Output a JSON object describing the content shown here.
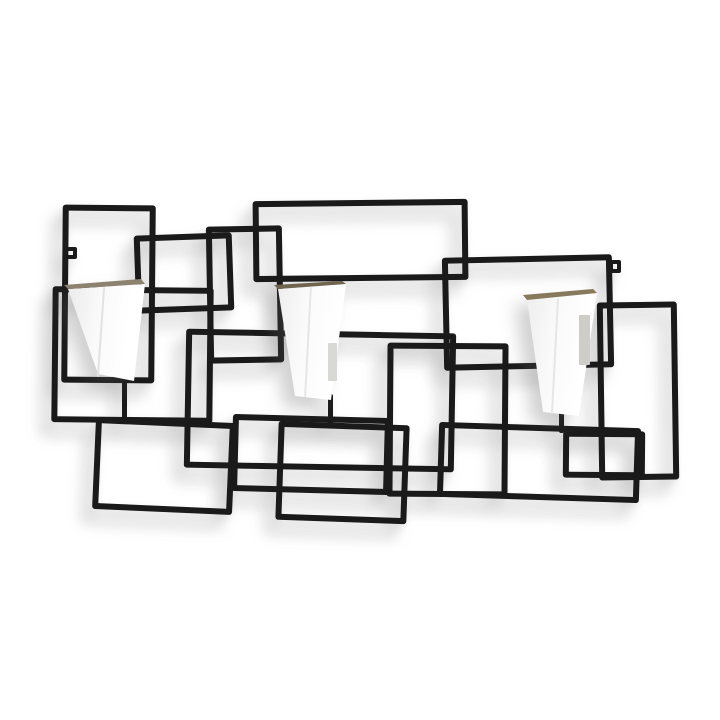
{
  "scene": {
    "canvas": {
      "width": 720,
      "height": 720,
      "background_color": "#ffffff"
    },
    "frame": {
      "wire_color": "#1a1a1a",
      "wire_thickness": 6,
      "rectangles": [
        {
          "name": "frame-rect-top-left-tall",
          "x": 62,
          "y": 205,
          "w": 93,
          "h": 178,
          "rot": 0.5
        },
        {
          "name": "frame-rect-left-small-square",
          "x": 135,
          "y": 234,
          "w": 98,
          "h": 78,
          "rot": -2
        },
        {
          "name": "frame-rect-center-left-tall",
          "x": 207,
          "y": 226,
          "w": 76,
          "h": 137,
          "rot": -1
        },
        {
          "name": "frame-rect-top-center-wide",
          "x": 253,
          "y": 200,
          "w": 215,
          "h": 81,
          "rot": -0.6
        },
        {
          "name": "frame-rect-top-right",
          "x": 443,
          "y": 256,
          "w": 170,
          "h": 113,
          "rot": -1.2
        },
        {
          "name": "frame-rect-far-right",
          "x": 598,
          "y": 302,
          "w": 80,
          "h": 178,
          "rot": -0.8
        },
        {
          "name": "frame-rect-left-mid",
          "x": 52,
          "y": 287,
          "w": 161,
          "h": 136,
          "rot": 0.6
        },
        {
          "name": "frame-rect-center-mid-wide",
          "x": 185,
          "y": 331,
          "w": 270,
          "h": 139,
          "rot": 1
        },
        {
          "name": "frame-rect-center-square",
          "x": 387,
          "y": 343,
          "w": 121,
          "h": 154,
          "rot": 0.4
        },
        {
          "name": "frame-rect-bottom-left",
          "x": 94,
          "y": 420,
          "w": 140,
          "h": 92,
          "rot": 2.5
        },
        {
          "name": "frame-rect-bottom-center-wide",
          "x": 232,
          "y": 416,
          "w": 158,
          "h": 77,
          "rot": 1.5
        },
        {
          "name": "frame-rect-bottom-center",
          "x": 277,
          "y": 423,
          "w": 131,
          "h": 99,
          "rot": 2
        },
        {
          "name": "frame-rect-bottom-right-wide",
          "x": 438,
          "y": 425,
          "w": 202,
          "h": 75,
          "rot": 1.8
        },
        {
          "name": "frame-rect-bottom-right-inner",
          "x": 563,
          "y": 431,
          "w": 82,
          "h": 47,
          "rot": 0.5
        }
      ],
      "hooks": [
        {
          "name": "wall-hook-left-icon",
          "x": 64,
          "y": 247,
          "w": 13,
          "h": 12,
          "border": 4
        },
        {
          "name": "wall-hook-right-icon",
          "x": 609,
          "y": 260,
          "w": 12,
          "h": 13,
          "border": 4
        }
      ],
      "hanger_stubs": [
        {
          "name": "pot1-hanger-stub",
          "x": 122,
          "y": 370,
          "w": 5,
          "h": 52
        },
        {
          "name": "pot2-hanger-stub",
          "x": 328,
          "y": 394,
          "w": 5,
          "h": 32
        },
        {
          "name": "pot3-hanger-stub",
          "x": 559,
          "y": 408,
          "w": 5,
          "h": 25
        }
      ]
    },
    "pots": [
      {
        "name": "planter-pot-left",
        "x": 64,
        "y": 278,
        "w": 84,
        "h": 104,
        "body_clip": "polygon(4px 11px, 81px 6px, 70px 103px, 34px 96px)",
        "body_gradient": "linear-gradient(97deg, #e9e9e9 0%, #f9f9f9 38%, #ffffff 72%)",
        "rim_clip": "polygon(4px 11px, 81px 6px, 77px 1px, 0px 7px)",
        "rim_color": "#8d8270",
        "crease": {
          "left": 36,
          "top": 9,
          "h": 90,
          "rot": 4,
          "color": "#e2e2e2"
        },
        "slot": null
      },
      {
        "name": "planter-pot-center",
        "x": 274,
        "y": 281,
        "w": 78,
        "h": 122,
        "body_clip": "polygon(4px 8px, 72px 3px, 57px 119px, 21px 115px)",
        "body_gradient": "linear-gradient(99deg, #ededed 0%, #fbfbfb 42%, #ffffff 75%)",
        "rim_clip": "polygon(4px 8px, 72px 3px, 68px 0px, 0px 4px)",
        "rim_color": "#6f654e",
        "crease": {
          "left": 33,
          "top": 6,
          "h": 110,
          "rot": 3,
          "color": "#e6e6e6"
        },
        "slot": {
          "left": 54,
          "top": 62,
          "w": 9,
          "h": 38,
          "color": "#d8d8d4"
        }
      },
      {
        "name": "planter-pot-right",
        "x": 522,
        "y": 289,
        "w": 80,
        "h": 130,
        "body_clip": "polygon(5px 11px, 75px 4px, 57px 127px, 21px 123px)",
        "body_gradient": "linear-gradient(99deg, #ececec 0%, #fafafa 40%, #ffffff 72%)",
        "rim_clip": "polygon(5px 11px, 75px 4px, 71px 0px, 1px 6px)",
        "rim_color": "#87795c",
        "crease": {
          "left": 32,
          "top": 9,
          "h": 116,
          "rot": 3,
          "color": "#e6e6e6"
        },
        "slot": {
          "left": 57,
          "top": 26,
          "w": 11,
          "h": 50,
          "color": "#cfcdc8"
        }
      }
    ]
  }
}
